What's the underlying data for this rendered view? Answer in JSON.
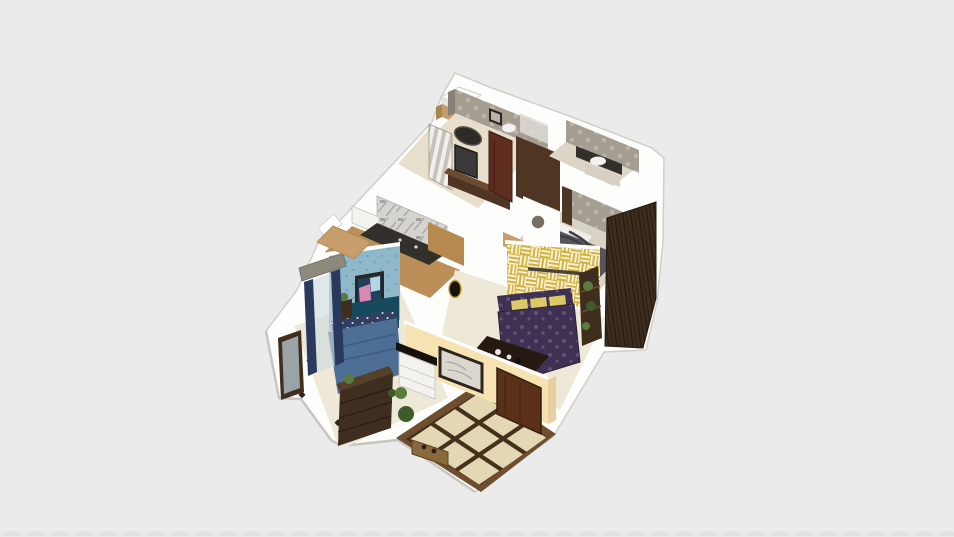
{
  "scene": {
    "type": "3d-floorplan-render",
    "description": "Isometric overhead 3D render of a furnished apartment floating on a plain light-gray background, no UI chrome visible",
    "rooms": [
      {
        "id": "bathroom-top",
        "label": "Bathroom",
        "wall": "gray textured tile",
        "items": [
          "tan cabinet",
          "white box",
          "wall frames",
          "toilet",
          "shower panel"
        ]
      },
      {
        "id": "dressing-hall",
        "label": "Hallway / dressing area",
        "items": [
          "oval wall mirror",
          "dark vanity desk",
          "striped cabinet",
          "red-brown door"
        ]
      },
      {
        "id": "bathroom-right",
        "label": "Second bathroom",
        "items": [
          "dark counter with white sink",
          "beige cabinet"
        ]
      },
      {
        "id": "bedroom-gray",
        "label": "Bedroom with gray bed",
        "wall": "gray damask wallpaper and brown accent",
        "items": [
          "unmade gray bed",
          "tall brown wardrobe",
          "porthole wall opening"
        ]
      },
      {
        "id": "kitchen",
        "label": "Kitchen",
        "wall": "marble patterned backsplash",
        "items": [
          "dark counter",
          "white appliance"
        ]
      },
      {
        "id": "bedroom-blue",
        "label": "Bedroom with blue bed",
        "wall": "light blue floral wallpaper",
        "items": [
          "abstract wall art",
          "navy headboard",
          "blue double bed",
          "nightstand with plant",
          "foot-of-bed dresser",
          "standing mirror",
          "navy curtains with gray pelmet"
        ]
      },
      {
        "id": "living-room",
        "label": "Living room",
        "wall": "mustard-yellow geometric accent wall",
        "items": [
          "purple damask sofa with yellow cushions",
          "coffee table",
          "plant ladder shelf",
          "dark oval wall decor"
        ]
      },
      {
        "id": "entry",
        "label": "Entry hall",
        "wall": "cream",
        "floor": "beige tile with dark diamond grid",
        "items": [
          "entry door",
          "black-top console with white drawers",
          "framed sketch",
          "potted plants",
          "bench"
        ]
      }
    ]
  },
  "colors": {
    "background": "#ebebeb",
    "wallWhite": "#fdfdfc",
    "wallShade": "#e7e5e0",
    "outline": "#d2cfca",
    "creamWall": "#f7e2b1",
    "creamWallShade": "#e9cfa0",
    "yellowBase": "#d3b33a",
    "yellowStripe": "#f6f1dd",
    "bluePaperBase": "#8fb9ca",
    "bluePaperMotif": "#5f93ab",
    "damaskBase": "#a49d91",
    "damaskMotif": "#c2bcb1",
    "marbleBase": "#d6d4d1",
    "marbleVein": "#8f8d8a",
    "grayWallDark": "#85817a",
    "floorBeige": "#e7decc",
    "floorPale": "#eee8d9",
    "floorGray": "#d9d3c6",
    "floorTan": "#bd8f58",
    "tanCabinet": "#c79e6b",
    "tileBase": "#e4d7b4",
    "tileLine": "#46301c",
    "tileBorder": "#6e4e2e",
    "woodDark": "#3f2d1e",
    "woodDarker": "#2a1d12",
    "doorBrown": "#5a3118",
    "doorRed": "#5e2d1f",
    "wallBrown": "#4f3524",
    "counterDark": "#33302b",
    "bedBlue": "#4d6f95",
    "pillowNavy": "#323f60",
    "headboardTeal": "#17495f",
    "bedGray": "#56565a",
    "bedGrayDark": "#3e3e44",
    "mattressWhite": "#efeeea",
    "sofaPurple": "#3f3152",
    "sofaMotif": "#6a5a86",
    "cushionYellow": "#ddc966",
    "plantGreen": "#5a7c3e",
    "plantDark": "#3e5c2a",
    "curtainNavy": "#2a3a5e",
    "pelmetGray": "#8d897c",
    "mirrorGlass": "#9aa3a8",
    "frameDark": "#2b2521",
    "artTealDark": "#21405c",
    "artPink": "#d98ab4",
    "artBlue": "#b9d4e2",
    "sinkWhite": "#f3f2ef",
    "clockGold": "#c9a227",
    "benchTan": "#8a6a3c",
    "stripeCabA": "#f2f0ec",
    "stripeCabB": "#c7c3bb",
    "bottomStrip": "#d9d9d9"
  }
}
